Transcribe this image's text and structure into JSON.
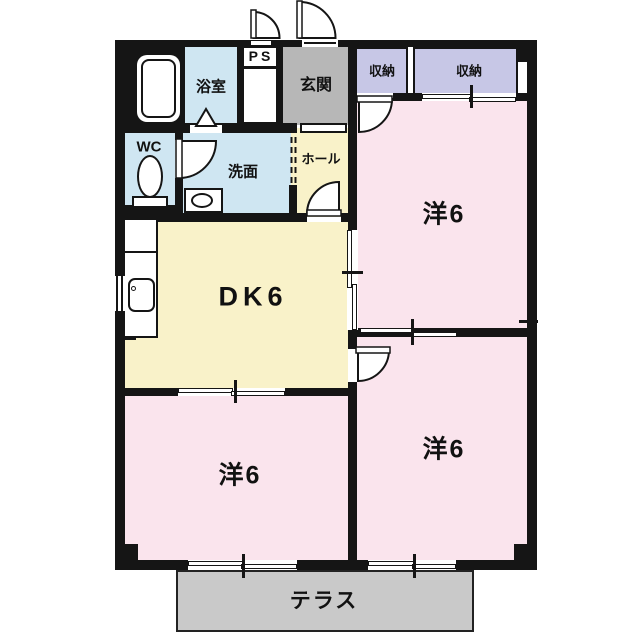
{
  "plan_type": "apartment-floor-plan",
  "rooms": {
    "bathroom": {
      "label": "浴室"
    },
    "pipe_space": {
      "label": "PS"
    },
    "entrance": {
      "label": "玄関"
    },
    "closet_left": {
      "label": "収納"
    },
    "closet_right": {
      "label": "収納"
    },
    "toilet_room": {
      "label": "WC"
    },
    "washroom": {
      "label": "洗面"
    },
    "hall": {
      "label": "ホール"
    },
    "dining_kitchen": {
      "label": "DK6"
    },
    "western_room_upper_right": {
      "label": "洋6"
    },
    "western_room_lower_left": {
      "label": "洋6"
    },
    "western_room_lower_right": {
      "label": "洋6"
    },
    "terrace": {
      "label": "テラス"
    }
  },
  "fixtures": [
    "bathtub",
    "toilet-bowl",
    "washbasin",
    "kitchen-sink",
    "bath-folding-door"
  ],
  "colors": {
    "wall": "#151515",
    "wet_area": "#cfe6f2",
    "living_area": "#f9f2c9",
    "bedroom": "#fae4ed",
    "closet": "#c7c7e6",
    "entrance_gray": "#b7b7b7",
    "terrace_gray": "#c9c9c9",
    "background": "#ffffff"
  }
}
